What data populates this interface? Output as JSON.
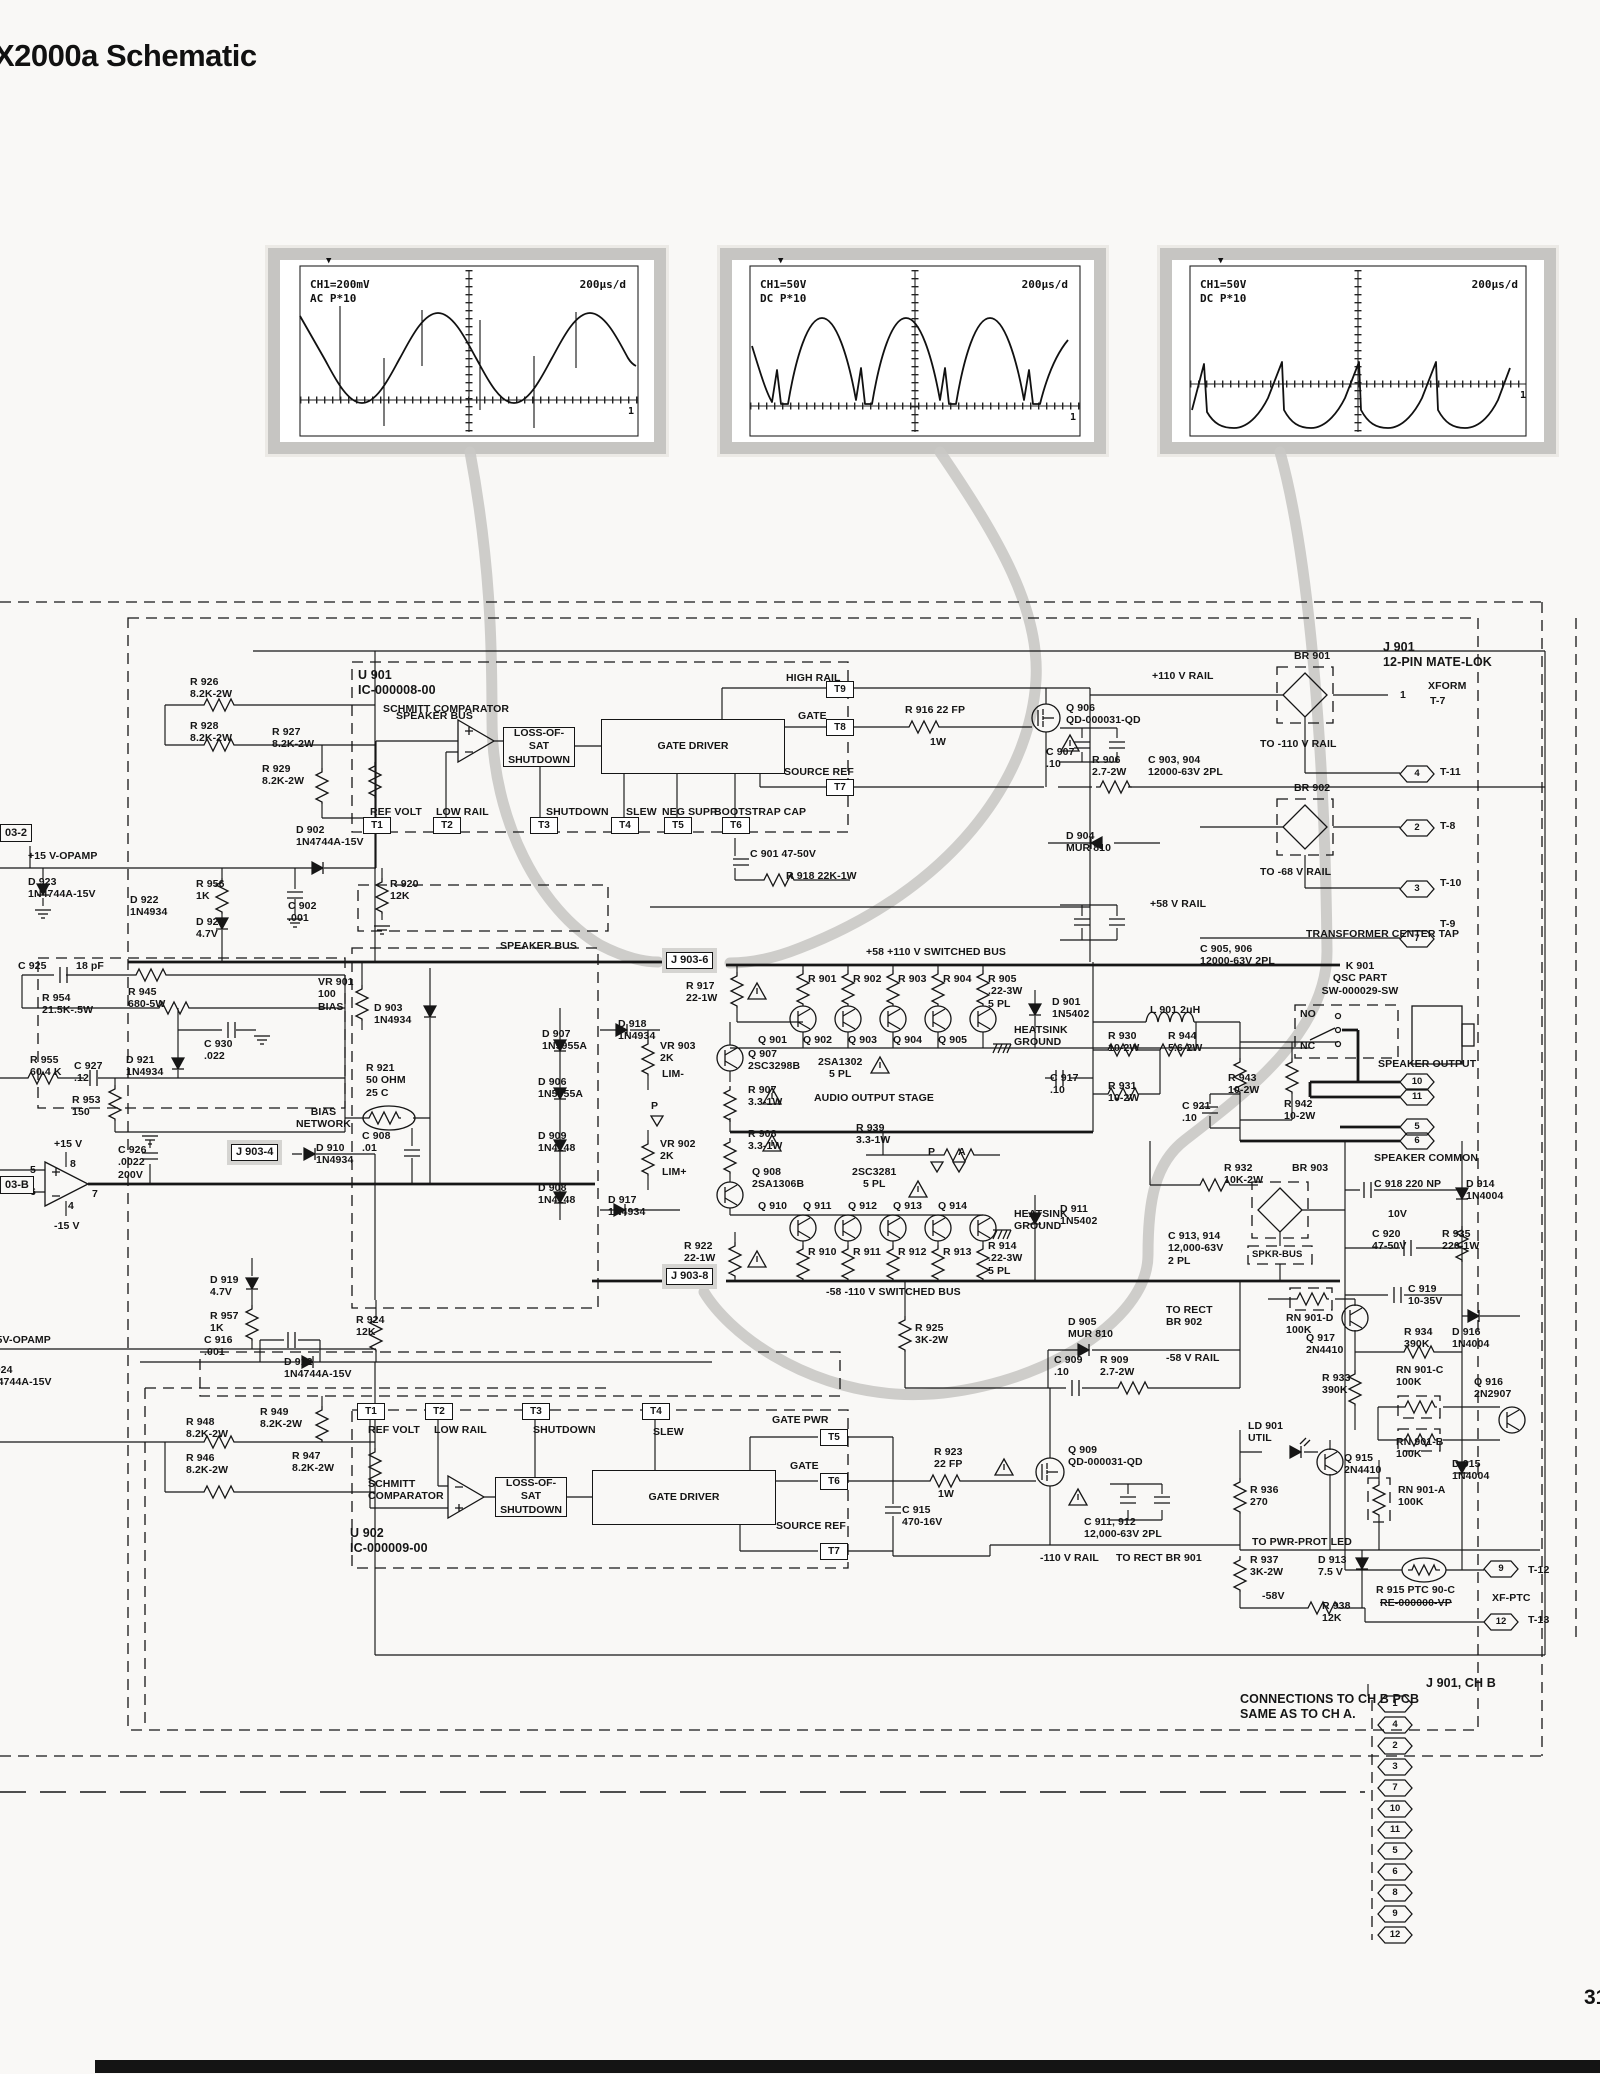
{
  "title": "X2000a Schematic",
  "page_number": "31",
  "scopes": [
    {
      "ch": "CH1=200mV\nAC P*10",
      "time": "200µs/d",
      "marker": "1",
      "trig": "▼"
    },
    {
      "ch": "CH1=50V\nDC P*10",
      "time": "200µs/d",
      "marker": "1",
      "trig": "▼"
    },
    {
      "ch": "CH1=50V\nDC P*10",
      "time": "200µs/d",
      "marker": "1",
      "trig": "▼"
    }
  ],
  "note": "CONNECTIONS TO CH B PCB\nSAME AS TO CH A.",
  "j901_chb": "J 901, CH B",
  "chb_pins": [
    "1",
    "4",
    "2",
    "3",
    "7",
    "10",
    "11",
    "5",
    "6",
    "8",
    "9",
    "12"
  ],
  "labels": {
    "u901": "U 901\nIC-000008-00",
    "schmitt1": "SCHMITT COMPARATOR",
    "loss1": "LOSS-OF-SAT\nSHUTDOWN",
    "gatedrv": "GATE DRIVER",
    "t1": "T1",
    "t2": "T2",
    "t3": "T3",
    "t4": "T4",
    "t5": "T5",
    "t6": "T6",
    "t7": "T7",
    "t8": "T8",
    "t9": "T9",
    "refvolt": "REF VOLT",
    "lowrail": "LOW RAIL",
    "shutdown": "SHUTDOWN",
    "slew": "SLEW",
    "negsupp": "NEG SUPP",
    "bootstrap": "BOOTSTRAP CAP",
    "highrail": "HIGH RAIL",
    "gate": "GATE",
    "srcref": "SOURCE REF",
    "gatepwr": "GATE PWR",
    "r926": "R 926\n8.2K-2W",
    "r928": "R 928\n8.2K-2W",
    "r927": "R 927\n8.2K-2W",
    "r929": "R 929\n8.2K-2W",
    "d902": "D 902\n1N4744A-15V",
    "r956": "R 956\n1K",
    "d922": "D 922\n1N4934",
    "d920": "D 920\n4.7V",
    "c902": "C 902\n.001",
    "r920": "R 920\n12K",
    "box032": "03-2",
    "p15opamp": "+15 V-OPAMP",
    "d923": "D 923\n1N4744A-15V",
    "r916": "R 916   22 FP",
    "w1": "1W",
    "c901": "C 901   47-50V",
    "r918": "R 918  22K-1W",
    "q906": "Q 906\nQD-000031-QD",
    "c907": "C 907\n.10",
    "r906": "R 906\n2.7-2W",
    "c903": "C 903, 904\n12000-63V 2PL",
    "rail110": "+110 V RAIL",
    "br901": "BR 901",
    "j901": "J 901\n12-PIN MATE-LOK",
    "xform": "XFORM",
    "t7x": "T-7",
    "pin1": "1",
    "to110": "TO -110 V RAIL",
    "t11x": "T-11",
    "br902": "BR 902",
    "t8x": "T-8",
    "d904": "D 904\nMUR 810",
    "to68": "TO -68 V RAIL",
    "t10x": "T-10",
    "rail58": "+58 V RAIL",
    "t9x": "T-9",
    "ctap": "TRANSFORMER CENTER TAP",
    "c905": "C 905, 906\n12000-63V 2PL",
    "c925": "C 925",
    "pf18": "18 pF",
    "r954": "R 954\n21.5K-.5W",
    "r945": "R 945\n680-5W",
    "r955": "R 955\n60.4 K",
    "c927": "C 927\n.12",
    "d921": "D 921\n1N4934",
    "r953": "R 953\n150",
    "c930": "C 930\n.022",
    "d903": "D 903\n1N4934",
    "vr901": "VR 901\n100\nBIAS",
    "r921": "R 921\n50 OHM\n25 C",
    "biasnet": "BIAS\nNETWORK",
    "c908": "C 908\n.01",
    "c926": "C 926\n.0022\n200V",
    "p15": "+15 V",
    "m15": "-15 V",
    "op4": "4",
    "op5": "5",
    "op6": "6",
    "op7": "7",
    "op8": "8",
    "box903b": "03-B",
    "j9034": "J 903-4",
    "d910": "D 910\n1N4934",
    "sb": "SPEAKER BUS",
    "j9036": "J 903-6",
    "r917": "R 917\n22-1W",
    "swbusp": "+58 +110 V SWITCHED BUS",
    "r901": "R 901",
    "r902": "R 902",
    "r903": "R 903",
    "r904": "R 904",
    "r905": "R 905\n.22-3W\n5 PL",
    "q901": "Q 901",
    "q902": "Q 902",
    "q903": "Q 903",
    "q904": "Q 904",
    "q905": "Q 905",
    "sa1302": "2SA1302\n5 PL",
    "hsground": "HEATSINK\nGROUND",
    "d907": "D 907\n1N5955A",
    "d918": "D 918\n1N4934",
    "vr903": "VR 903\n2K",
    "limm": "LIM-",
    "d906": "D 906\n1N5955A",
    "q907": "Q 907\n2SC3298B",
    "r907": "R 907\n3.3-1W",
    "aos": "AUDIO OUTPUT STAGE",
    "d909": "D 909\n1N4148",
    "r908": "R 908\n3.3-1W",
    "r939": "R 939\n3.3-1W",
    "vr902": "VR 902\n2K",
    "limp": "LIM+",
    "d908": "D 908\n1N4148",
    "d917": "D 917\n1N4934",
    "q908": "Q 908\n2SA1306B",
    "sc3281": "2SC3281\n5 PL",
    "pP": "P",
    "pA": "A",
    "q910": "Q 910",
    "q911": "Q 911",
    "q912": "Q 912",
    "q913": "Q 913",
    "q914": "Q 914",
    "r910": "R 910",
    "r911": "R 911",
    "r912": "R 912",
    "r913": "R 913",
    "r914": "R 914\n.22-3W\n5 PL",
    "d911": "D 911\n1N5402",
    "r922": "R 922\n22-1W",
    "j9038": "J 903-8",
    "swbusn": "-58 -110 V SWITCHED BUS",
    "r925": "R 925\n3K-2W",
    "d905": "D 905\nMUR 810",
    "c909": "C 909\n.10",
    "r909": "R 909\n2.7-2W",
    "d901": "D 901\n1N5402",
    "l901": "L 901    2uH",
    "r930": "R 930\n10-2W",
    "r944": "R 944\n5.6-2W",
    "c917": "C 917\n.10",
    "r931": "R 931\n10-2W",
    "k901": "K 901\nQSC PART\nSW-000029-SW",
    "no": "NO",
    "nc": "NC",
    "spkout": "SPEAKER OUTPUT",
    "spkcom": "SPEAKER COMMON",
    "r943": "R 943\n10-2W",
    "r942": "R 942\n10-2W",
    "c921": "C 921\n.10",
    "r932": "R 932\n10K-2W",
    "br903": "BR 903",
    "c918": "C 918   220 NP",
    "v10": "10V",
    "d914": "D 914\n1N4004",
    "c920": "C 920\n47-50V",
    "r935": "R 935\n220-1W",
    "c913": "C 913, 914\n12,000-63V\n2 PL",
    "spkrbus": "SPKR-BUS",
    "rn901d": "RN 901-D\n100K",
    "q917": "Q 917\n2N4410",
    "c919": "C 919\n10-35V",
    "r934": "R 934\n390K",
    "d916": "D 916\n1N4004",
    "torect902": "TO RECT\nBR 902",
    "m58rail": "-58 V RAIL",
    "r933": "R 933\n390K",
    "rn901c": "RN 901-C\n100K",
    "q916": "Q 916\n2N2907",
    "ld901": "LD 901\nUTIL",
    "q915": "Q 915\n2N4410",
    "rn901b": "RN 901-B\n100K",
    "d915": "D 915\n1N4004",
    "rn901a": "RN 901-A\n100K",
    "r936": "R 936\n270",
    "topwrled": "TO PWR-PROT LED",
    "r937": "R 937\n3K-2W",
    "d913": "D 913\n7.5 V",
    "t12x": "T-12",
    "r915": "R 915  PTC 90-C",
    "re0": "RE-000000-VP",
    "xfptc": "XF-PTC",
    "m58": "-58V",
    "r938": "R 938\n12K",
    "t13x": "T-13",
    "torect901": "TO RECT BR 901",
    "m110rail": "-110 V RAIL",
    "d919": "D 919\n4.7V",
    "r957": "R 957\n1K",
    "m15opamp": "-15V-OPAMP",
    "d924": "D 924\n1N4744A-15V",
    "c916": "C 916\n.001",
    "r924": "R 924\n12K",
    "d912": "D 912\n1N4744A-15V",
    "r948": "R 948\n8.2K-2W",
    "r949": "R 949\n8.2K-2W",
    "r946": "R 946\n8.2K-2W",
    "r947": "R 947\n8.2K-2W",
    "schmitt2": "SCHMITT\nCOMPARATOR",
    "loss2": "LOSS-OF-SAT\nSHUTDOWN",
    "u902": "U 902\nIC-000009-00",
    "r923": "R 923\n22 FP",
    "c915": "C 915\n470-16V",
    "q909": "Q 909\nQD-000031-QD",
    "c911": "C 911, 912\n12,000-63V 2PL",
    "pin2": "2",
    "pin3": "3",
    "pin4": "4",
    "pin5": "5",
    "pin6": "6",
    "pin7": "7",
    "pin9": "9",
    "pin10": "10",
    "pin11": "11",
    "pin12": "12"
  }
}
